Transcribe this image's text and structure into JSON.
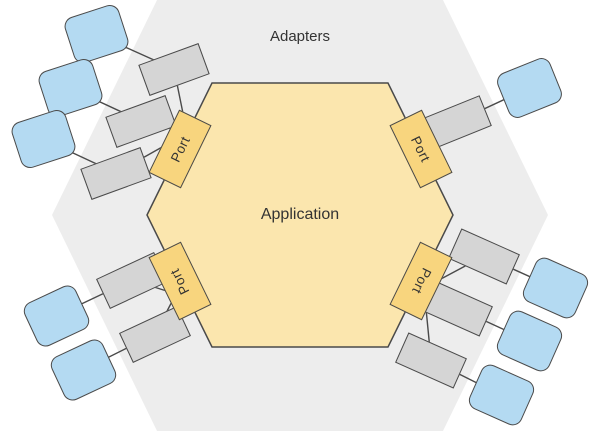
{
  "diagram": {
    "zone_label": "Adapters",
    "core_label": "Application",
    "port_label": "Port",
    "colors": {
      "background": "#ffffff",
      "zone": "#ededed",
      "app_fill": "#fbe6ae",
      "port_fill": "#f8d57e",
      "adapter_fill": "#d5d5d5",
      "external_fill": "#b4daf2",
      "stroke": "#4a4a4a",
      "text": "#333333"
    }
  }
}
